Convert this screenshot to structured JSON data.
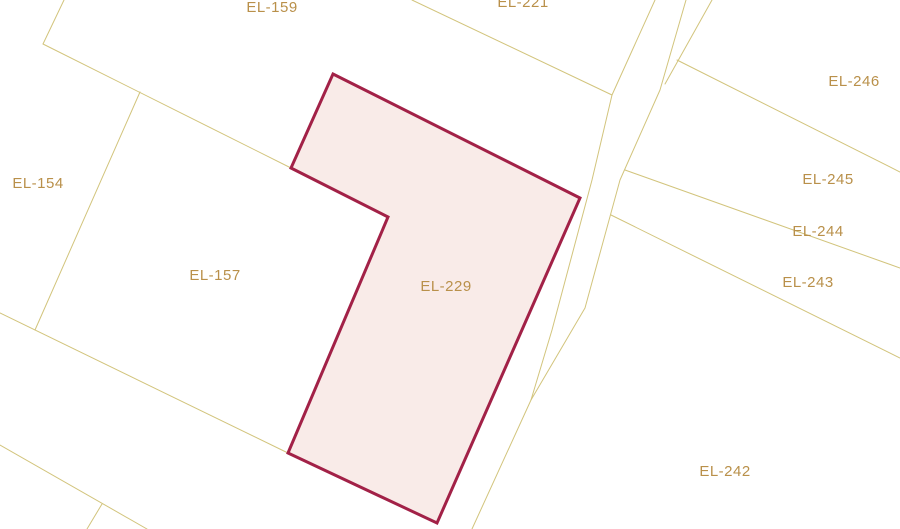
{
  "map": {
    "background_color": "#ffffff",
    "boundary_line_color": "#d2c47c",
    "label_color": "#b9904a",
    "selected_parcel": {
      "id": "EL-229",
      "fill_color": "#f9ebe8",
      "stroke_color": "#a22147",
      "stroke_width": 3,
      "polygon": [
        [
          333,
          74
        ],
        [
          580,
          198
        ],
        [
          437,
          523
        ],
        [
          288,
          453
        ],
        [
          388,
          217
        ],
        [
          291,
          168
        ]
      ]
    },
    "boundary_lines": [
      {
        "name": "el159-west-segment",
        "points": [
          [
            64,
            0
          ],
          [
            43,
            44
          ]
        ]
      },
      {
        "name": "el159-el157-boundary",
        "points": [
          [
            43,
            44
          ],
          [
            291,
            168
          ]
        ]
      },
      {
        "name": "el154-el157-boundary",
        "points": [
          [
            140,
            92
          ],
          [
            35,
            330
          ]
        ]
      },
      {
        "name": "el157-southwest-boundary",
        "points": [
          [
            0,
            313
          ],
          [
            288,
            453
          ]
        ]
      },
      {
        "name": "bottom-left-boundary",
        "points": [
          [
            0,
            445
          ],
          [
            147,
            529
          ]
        ]
      },
      {
        "name": "bottom-left-branch",
        "points": [
          [
            102,
            504
          ],
          [
            87,
            529
          ]
        ]
      },
      {
        "name": "el221-south-boundary",
        "points": [
          [
            412,
            0
          ],
          [
            612,
            95
          ]
        ]
      },
      {
        "name": "road-west-edge",
        "points": [
          [
            655,
            0
          ],
          [
            612,
            95
          ],
          [
            592,
            180
          ],
          [
            552,
            330
          ],
          [
            531,
            400
          ],
          [
            472,
            529
          ]
        ]
      },
      {
        "name": "road-east-edge",
        "points": [
          [
            686,
            0
          ],
          [
            660,
            90
          ],
          [
            620,
            180
          ],
          [
            585,
            308
          ],
          [
            531,
            400
          ]
        ]
      },
      {
        "name": "road-east-wedge",
        "points": [
          [
            712,
            0
          ],
          [
            665,
            84
          ]
        ]
      },
      {
        "name": "el246-el245-boundary",
        "points": [
          [
            677,
            60
          ],
          [
            900,
            172
          ]
        ]
      },
      {
        "name": "el245-el244-boundary",
        "points": [
          [
            625,
            170
          ],
          [
            900,
            268
          ]
        ]
      },
      {
        "name": "el244-el243-boundary",
        "points": [
          [
            611,
            215
          ],
          [
            900,
            358
          ]
        ]
      }
    ],
    "labels": [
      {
        "text": "EL-159",
        "x": 272,
        "y": 12
      },
      {
        "text": "EL-221",
        "x": 523,
        "y": 7
      },
      {
        "text": "EL-154",
        "x": 38,
        "y": 188
      },
      {
        "text": "EL-157",
        "x": 215,
        "y": 280
      },
      {
        "text": "EL-229",
        "x": 446,
        "y": 291
      },
      {
        "text": "EL-246",
        "x": 854,
        "y": 86
      },
      {
        "text": "EL-245",
        "x": 828,
        "y": 184
      },
      {
        "text": "EL-244",
        "x": 818,
        "y": 236
      },
      {
        "text": "EL-243",
        "x": 808,
        "y": 287
      },
      {
        "text": "EL-242",
        "x": 725,
        "y": 476
      }
    ]
  }
}
